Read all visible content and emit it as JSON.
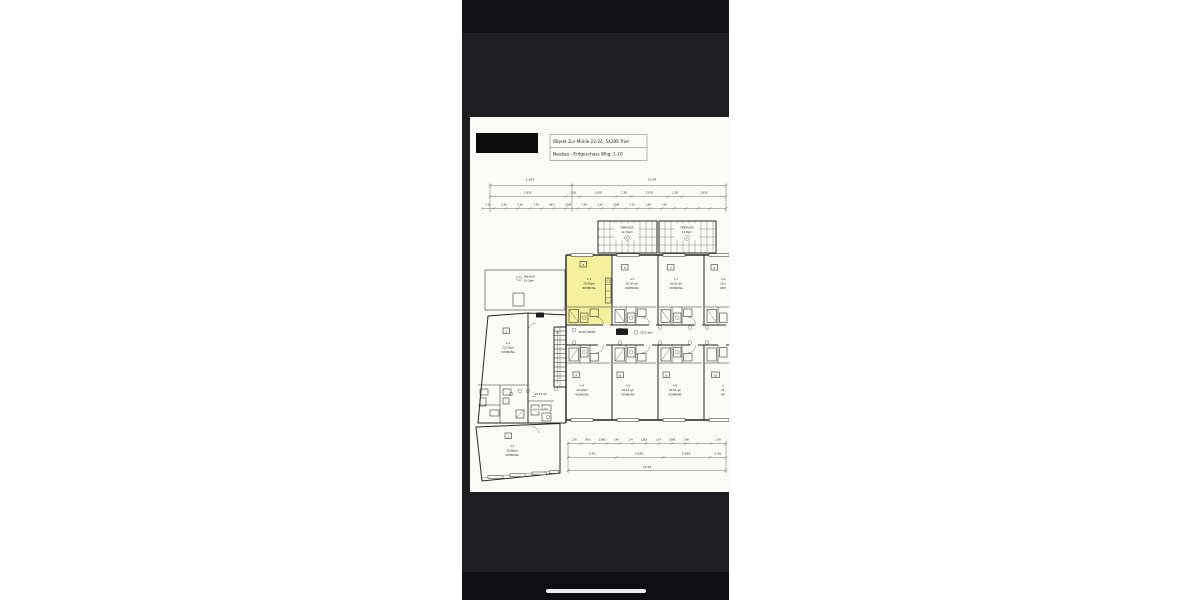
{
  "doc": {
    "title1": "Objekt Zur Mühle 22-24, 54295 Trier",
    "title2": "Neubau - Erdgeschoss Whg. 1-10"
  },
  "dims": {
    "top1": [
      "5.815",
      "15.99"
    ],
    "top2": [
      "5.815",
      "1.26",
      "3.635",
      "1.26",
      "3.635",
      "1.26",
      "3.635"
    ],
    "top3": [
      "1.15",
      "2.26",
      "2.26",
      "1.76",
      "88.5",
      "1.885",
      "1.48",
      "1.14",
      "1.885",
      "1.14",
      "1.48",
      "1.40"
    ],
    "bot1": [
      "1.76",
      "88.5",
      "1.885",
      "1.48",
      "1.14",
      "1.885",
      "1.14",
      "1.885",
      "1.48",
      "1.40"
    ],
    "bot2": [
      "3.76",
      "3.635",
      "3.635",
      "1.40"
    ],
    "total": "15.99"
  },
  "terraces": [
    {
      "no": "5",
      "name": "TERRASSE",
      "area": "12.79qm"
    },
    {
      "no": "7",
      "name": "TERRASSE",
      "area": "12.8qm"
    }
  ],
  "balkon": {
    "no": "2",
    "name": "BALKON",
    "area": "18.2qm"
  },
  "units": [
    {
      "no": "1",
      "code": "A 1",
      "area": "28.96qm",
      "type": "WOHNUNG"
    },
    {
      "no": "2",
      "code": "A 2",
      "area": "23.22qm",
      "type": "WOHNUNG"
    },
    {
      "no": "3",
      "code": "A 3",
      "area": "19.42qm",
      "type": "WOHNUNG"
    },
    {
      "no": "4",
      "code": "A 4",
      "area": "19.42qm",
      "type": "WOHNUNG"
    },
    {
      "no": "5",
      "code": "A 5",
      "area": "18.92 qm",
      "type": "WOHNUNG"
    },
    {
      "no": "6",
      "code": "A 6",
      "area": "18.92 qm",
      "type": "WOHNUNG"
    },
    {
      "no": "7",
      "code": "A 7",
      "area": "18.92 qm",
      "type": "WOHNUNG"
    },
    {
      "no": "8",
      "code": "A 8",
      "area": "18.92 qm",
      "type": "WOHNUNG"
    },
    {
      "no": "9",
      "code": "A 9",
      "area": "18.2",
      "type": "WOH"
    },
    {
      "no": "10",
      "code": "A",
      "area": "23.",
      "type": "WO"
    }
  ],
  "annotations": {
    "corridor_level": "±0.00 OKFFB",
    "corridor_area": "18.2 qm",
    "room_area": "20.52 qm",
    "room_level": "±0.00 OKFFB"
  },
  "colors": {
    "highlight": "#f5f09e",
    "paper": "#fbfbf8",
    "ink": "#262626",
    "phone_bg": "#1e1e20"
  }
}
